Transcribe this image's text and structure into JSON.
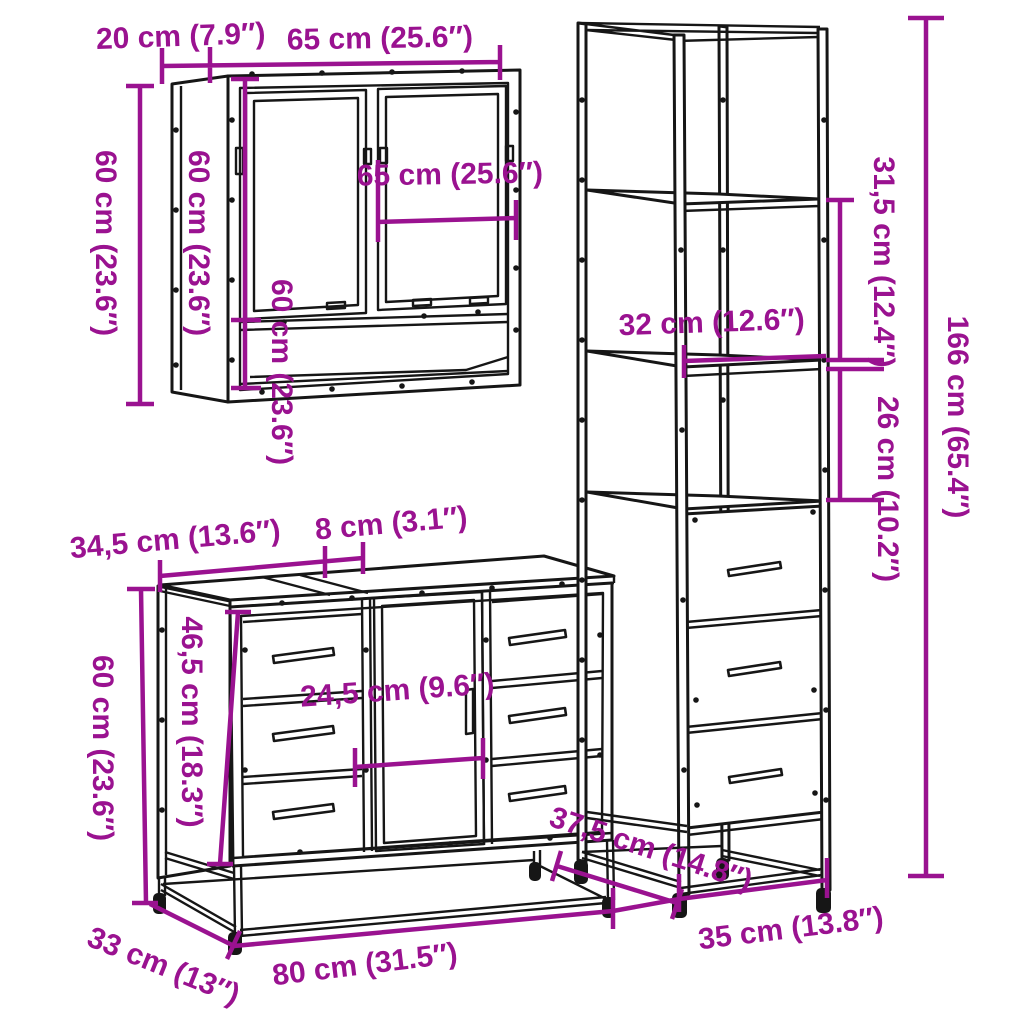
{
  "diagram": {
    "kind": "furniture dimension line-drawing, 3-piece bathroom set",
    "background_color": "#ffffff",
    "drawing_line_color": "#161616",
    "dimension_color": "#9A1290"
  },
  "mirror_cabinet": {
    "depth": "20 cm (7.9″)",
    "width": "65 cm (25.6″)",
    "height": "60 cm (23.6″)",
    "side_height": "60 cm (23.6″)",
    "inner_width": "65 cm (25.6″)",
    "inner_height": "60 cm (23.6″)"
  },
  "tall_cabinet": {
    "upper_shelf_spacing": "31,5 cm (12.4″)",
    "lower_shelf_spacing": "26 cm (10.2″)",
    "height": "166 cm (65.4″)",
    "shelf_width": "32 cm (12.6″)",
    "depth": "37,5 cm (14.8″)",
    "width": "35 cm (13.8″)"
  },
  "sink_cabinet": {
    "top_section_width": "34,5 cm (13.6″)",
    "top_gap": "8 cm (3.1″)",
    "height": "60 cm (23.6″)",
    "inner_height": "46,5 cm (18.3″)",
    "door_width": "24,5 cm (9.6″)",
    "width": "80 cm (31.5″)",
    "depth": "33 cm (13″)"
  }
}
